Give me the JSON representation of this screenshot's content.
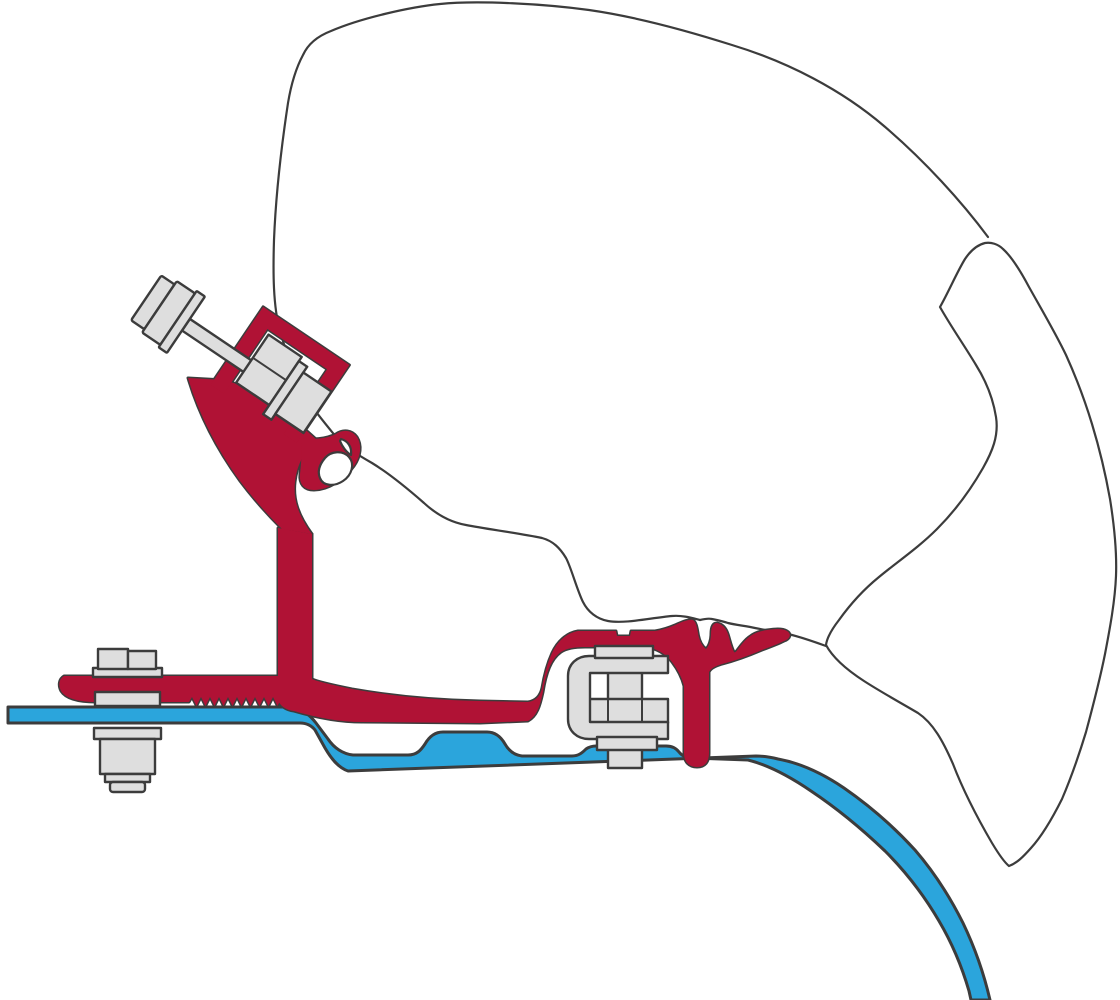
{
  "colors": {
    "background": "#FFFFFF",
    "outline": "#3C3C3C",
    "bracket_red": "#B01235",
    "rail_blue": "#2BA5DC",
    "metal_gray": "#DEDEDE"
  },
  "diagram": {
    "kind": "awning-adapter-installation-cross-section",
    "parts": [
      {
        "id": "awning-case-profile",
        "color_key": "background"
      },
      {
        "id": "awning-case-lead-rail-profile",
        "color_key": "background"
      },
      {
        "id": "adapter-bracket-profile",
        "color_key": "bracket_red"
      },
      {
        "id": "roof-rail-profile",
        "color_key": "rail_blue"
      },
      {
        "id": "diagonal-clamp-bolt",
        "color_key": "metal_gray"
      },
      {
        "id": "rear-fixing-bolt",
        "color_key": "metal_gray"
      },
      {
        "id": "central-clamp-bolt",
        "color_key": "metal_gray"
      }
    ]
  }
}
